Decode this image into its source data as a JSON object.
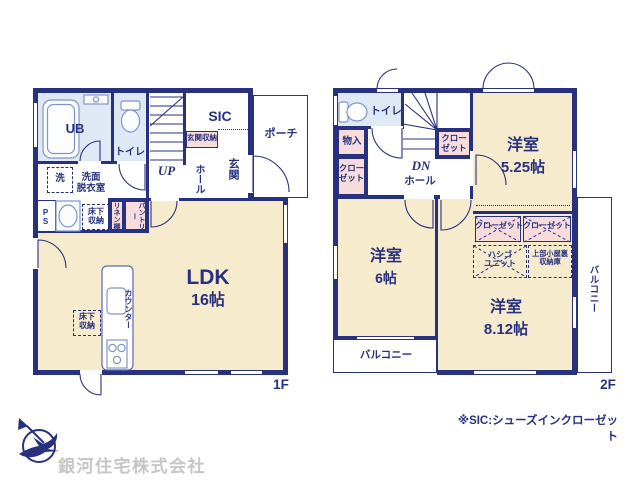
{
  "colors": {
    "wall_navy": "#28317e",
    "room_beige": "#f7ebcd",
    "closet_pink": "#f8dcdc",
    "wet_area_blue": "#dfe9f6",
    "fixture_blue": "#8094cc",
    "company_gray": "#c6c6c6"
  },
  "floor1": {
    "floor_label": "1F",
    "rooms": {
      "ub": "UB",
      "toilet": "トイレ",
      "sic": "SIC",
      "entrance_storage": "玄関収納",
      "entrance": "玄関",
      "hall": "ホール",
      "porch": "ポーチ",
      "stairs_up": "UP",
      "washer": "洗",
      "washroom_line1": "洗面",
      "washroom_line2": "脱衣室",
      "ps": "PS",
      "underfloor_line1": "床下",
      "underfloor_line2": "収納",
      "linen_shelf": "リネン棚",
      "pantry": "パントリー",
      "ldk": "LDK",
      "ldk_size": "16帖",
      "counter": "カウンター"
    }
  },
  "floor2": {
    "floor_label": "2F",
    "rooms": {
      "toilet": "トイレ",
      "stairs_dn": "DN",
      "storage": "物入",
      "closet_line1": "クロー",
      "closet_line2": "ゼット",
      "closet": "クローゼット",
      "hall": "ホール",
      "room_525": "洋室",
      "room_525_size": "5.25帖",
      "room_6": "洋室",
      "room_6_size": "6帖",
      "room_812": "洋室",
      "room_812_size": "8.12帖",
      "ladder_line1": "ハシゴ",
      "ladder_line2": "ユニット",
      "attic_line1": "上部小屋裏",
      "attic_line2": "収納庫",
      "balcony": "バルコニー"
    }
  },
  "footer": {
    "company": "銀河住宅株式会社",
    "note": "※SIC:シューズインクローゼット"
  }
}
